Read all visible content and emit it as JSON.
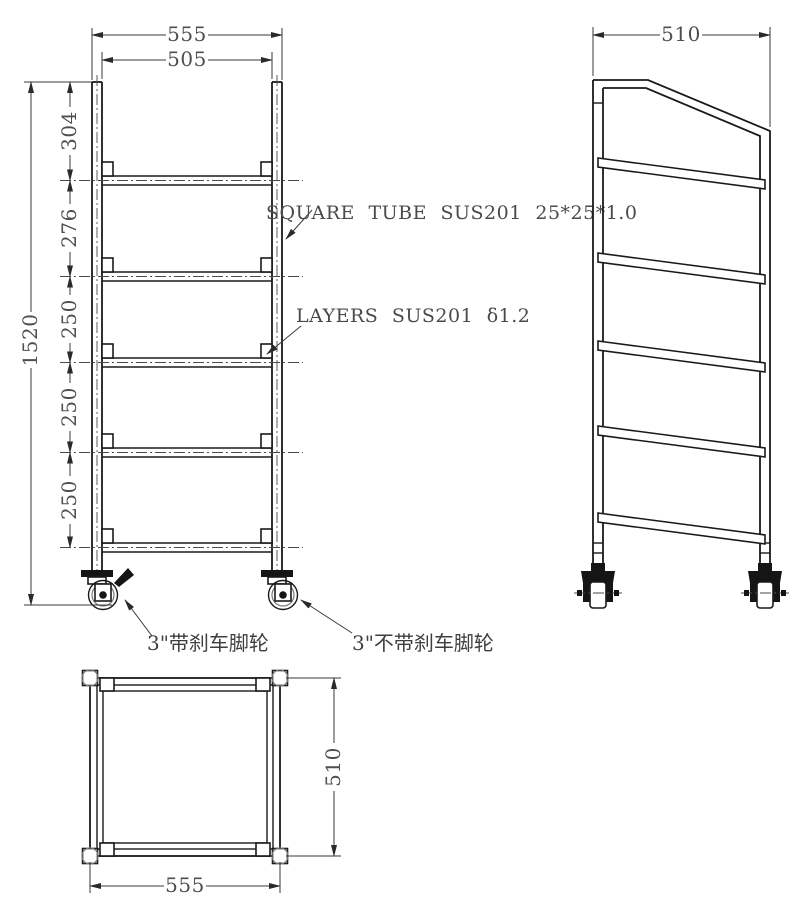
{
  "drawing_type": "trolley-rack-engineering-drawing",
  "colors": {
    "object_line": "#1a1a1a",
    "dimension_line": "#3a3a3a",
    "text": "#4f4f4f"
  },
  "front_view": {
    "width_outer": "555",
    "width_inner": "505",
    "total_height": "1520",
    "segments": [
      "304",
      "276",
      "250",
      "250",
      "250"
    ],
    "tube_note": "SQUARE TUBE SUS201 25*25*1.0",
    "layers_note": "LAYERS SUS201 δ1.2",
    "caster_brake_note": "3\"带刹车脚轮",
    "caster_plain_note": "3\"不带刹车脚轮"
  },
  "side_view": {
    "depth": "510"
  },
  "bottom_view": {
    "width": "555",
    "depth": "510"
  }
}
